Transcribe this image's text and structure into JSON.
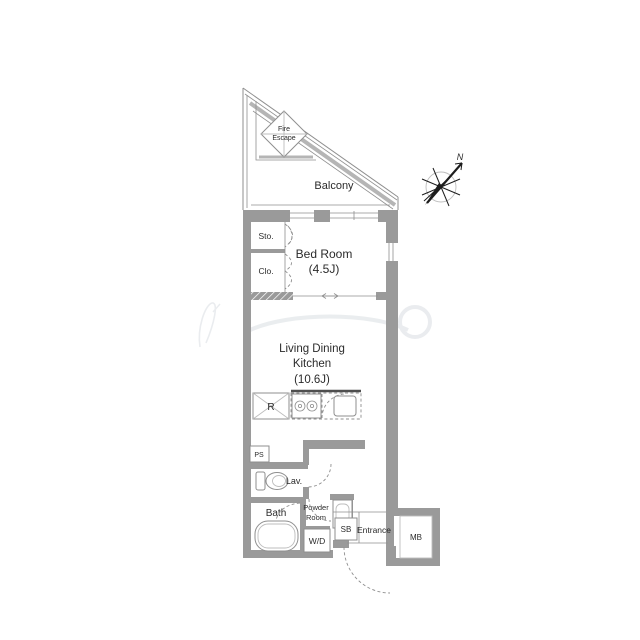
{
  "plan": {
    "balcony": {
      "label": "Balcony"
    },
    "fire_escape": {
      "line1": "Fire",
      "line2": "Escape"
    },
    "compass": {
      "north_label": "N"
    },
    "storage": {
      "label": "Sto."
    },
    "closet": {
      "label": "Clo."
    },
    "bedroom": {
      "name": "Bed Room",
      "size": "(4.5J)"
    },
    "ldk": {
      "name_line1": "Living Dining",
      "name_line2": "Kitchen",
      "size": "(10.6J)"
    },
    "kitchen": {
      "refrigerator_label": "R"
    },
    "pipe_space": {
      "label": "PS"
    },
    "lavatory": {
      "label": "Lav."
    },
    "bath": {
      "name": "Bath",
      "size": "(1216)"
    },
    "powder_room": {
      "line1": "Powder",
      "line2": "Room"
    },
    "washer_dryer": {
      "label": "W/D"
    },
    "shoe_box": {
      "label": "SB"
    },
    "entrance": {
      "label": "Entrance"
    },
    "meter_box": {
      "label": "MB"
    }
  },
  "colors": {
    "wall": "#9a9a9a",
    "line": "#8f8f8f",
    "rail": "#b5b5b5",
    "dark": "#4f4f4f",
    "text": "#2b2b2b",
    "wm": "#dfe3e7",
    "bg": "#ffffff"
  }
}
